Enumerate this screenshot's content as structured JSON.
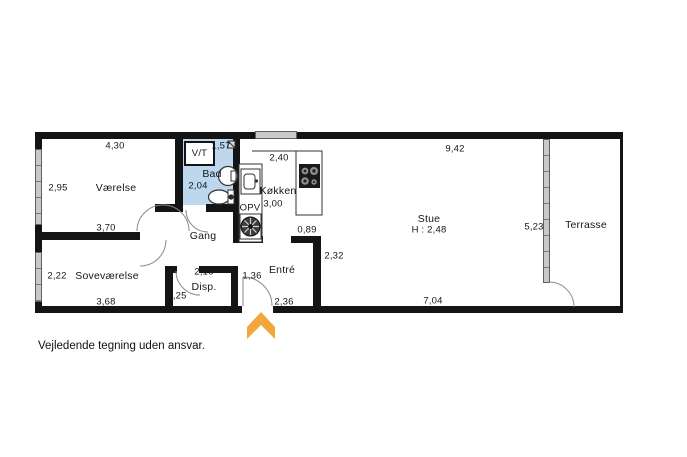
{
  "footer": {
    "disclaimer": "Vejledende tegning uden ansvar."
  },
  "colors": {
    "wall": "#141414",
    "bathroom_fill": "#bdd7ee",
    "window_fill": "#c9c9c9",
    "entrance_arrow": "#f2a63c"
  },
  "icons": {
    "entrance_arrow": "chevron-up",
    "stove": "cooktop-4-burners",
    "kitchen_sink": "sink",
    "washing_machine": "washing-machine",
    "toilet": "toilet",
    "washbasin": "washbasin",
    "drain": "floor-drain"
  },
  "rooms": {
    "vaerelse": {
      "name": "Værelse",
      "dim_top": "4,30",
      "dim_left": "2,95",
      "dim_bottom": "3,70"
    },
    "vt": {
      "name": "V/T"
    },
    "bad": {
      "name": "Bad",
      "dim_top": "1,57",
      "dim_left": "2,04"
    },
    "koekken": {
      "name": "Køkken",
      "dim_top": "2,40",
      "dim_left": "3,00",
      "appliance": "OPV"
    },
    "gang": {
      "name": "Gang"
    },
    "stue": {
      "name": "Stue",
      "ceiling_height": "H : 2,48",
      "dim_top": "9,42",
      "dim_bottom": "7,04",
      "dim_right": "5,23",
      "dim_wall_left": "2,32",
      "dim_opening": "0,89"
    },
    "terrasse": {
      "name": "Terrasse"
    },
    "sovevaerelse": {
      "name": "Soveværelse",
      "dim_left": "2,22",
      "dim_bottom": "3,68"
    },
    "disp": {
      "name": "Disp.",
      "dim_top": "2,18",
      "dim_left": "1,25"
    },
    "entre": {
      "name": "Entré",
      "dim_left": "1,36",
      "dim_bottom": "2,36"
    }
  }
}
